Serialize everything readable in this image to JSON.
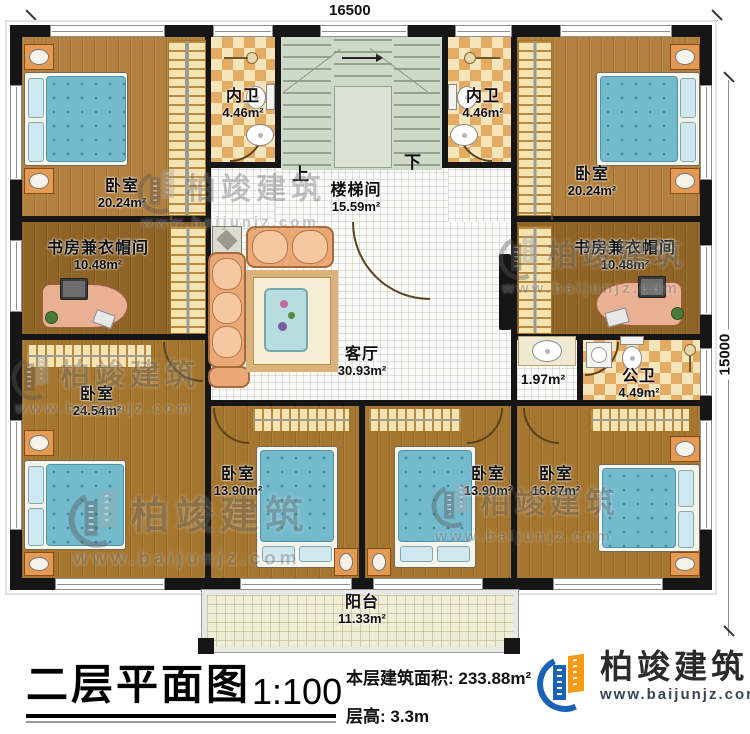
{
  "dimensions": {
    "top": "16500",
    "right": "15000"
  },
  "stairs": {
    "up": "上",
    "down": "下"
  },
  "rooms": [
    {
      "id": "bedroom-top-left",
      "name": "卧室",
      "area": "20.24m²"
    },
    {
      "id": "bath-top-left",
      "name": "内卫",
      "area": "4.46m²"
    },
    {
      "id": "stairwell",
      "name": "楼梯间",
      "area": "15.59m²"
    },
    {
      "id": "bath-top-right",
      "name": "内卫",
      "area": "4.46m²"
    },
    {
      "id": "bedroom-top-right",
      "name": "卧室",
      "area": "20.24m²"
    },
    {
      "id": "study-left",
      "name": "书房兼衣帽间",
      "area": "10.48m²"
    },
    {
      "id": "study-right",
      "name": "书房兼衣帽间",
      "area": "10.48m²"
    },
    {
      "id": "living-room",
      "name": "客厅",
      "area": "30.93m²"
    },
    {
      "id": "hallway",
      "name": "",
      "area": "1.97m²"
    },
    {
      "id": "bath-public",
      "name": "公卫",
      "area": "4.49m²"
    },
    {
      "id": "bedroom-bottom-left",
      "name": "卧室",
      "area": "24.54m²"
    },
    {
      "id": "bedroom-bottom-mid1",
      "name": "卧室",
      "area": "13.90m²"
    },
    {
      "id": "bedroom-bottom-mid2",
      "name": "卧室",
      "area": "13.90m²"
    },
    {
      "id": "bedroom-bottom-right",
      "name": "卧室",
      "area": "16.87m²"
    },
    {
      "id": "balcony",
      "name": "阳台",
      "area": "11.33m²"
    }
  ],
  "title_block": {
    "title": "二层平面图",
    "scale": "1:100",
    "floor_area": "本层建筑面积: 233.88m²",
    "floor_height": "层高: 3.3m"
  },
  "brand": {
    "name": "柏竣建筑",
    "url": "www.baijunjz.com"
  },
  "watermark": {
    "name": "柏竣建筑",
    "url": "www.baijunjz.com"
  },
  "colors": {
    "wall": "#161616",
    "brand_blue": "#1a62b5",
    "brand_orange": "#f49a15",
    "wood_light": "#b28140",
    "wood_dark": "#8f6426",
    "wood_mid": "#a5762f",
    "checker_dark": "#e0a75e",
    "checker_light": "#f6e4ba",
    "stair_green": "#cfd9ca"
  }
}
